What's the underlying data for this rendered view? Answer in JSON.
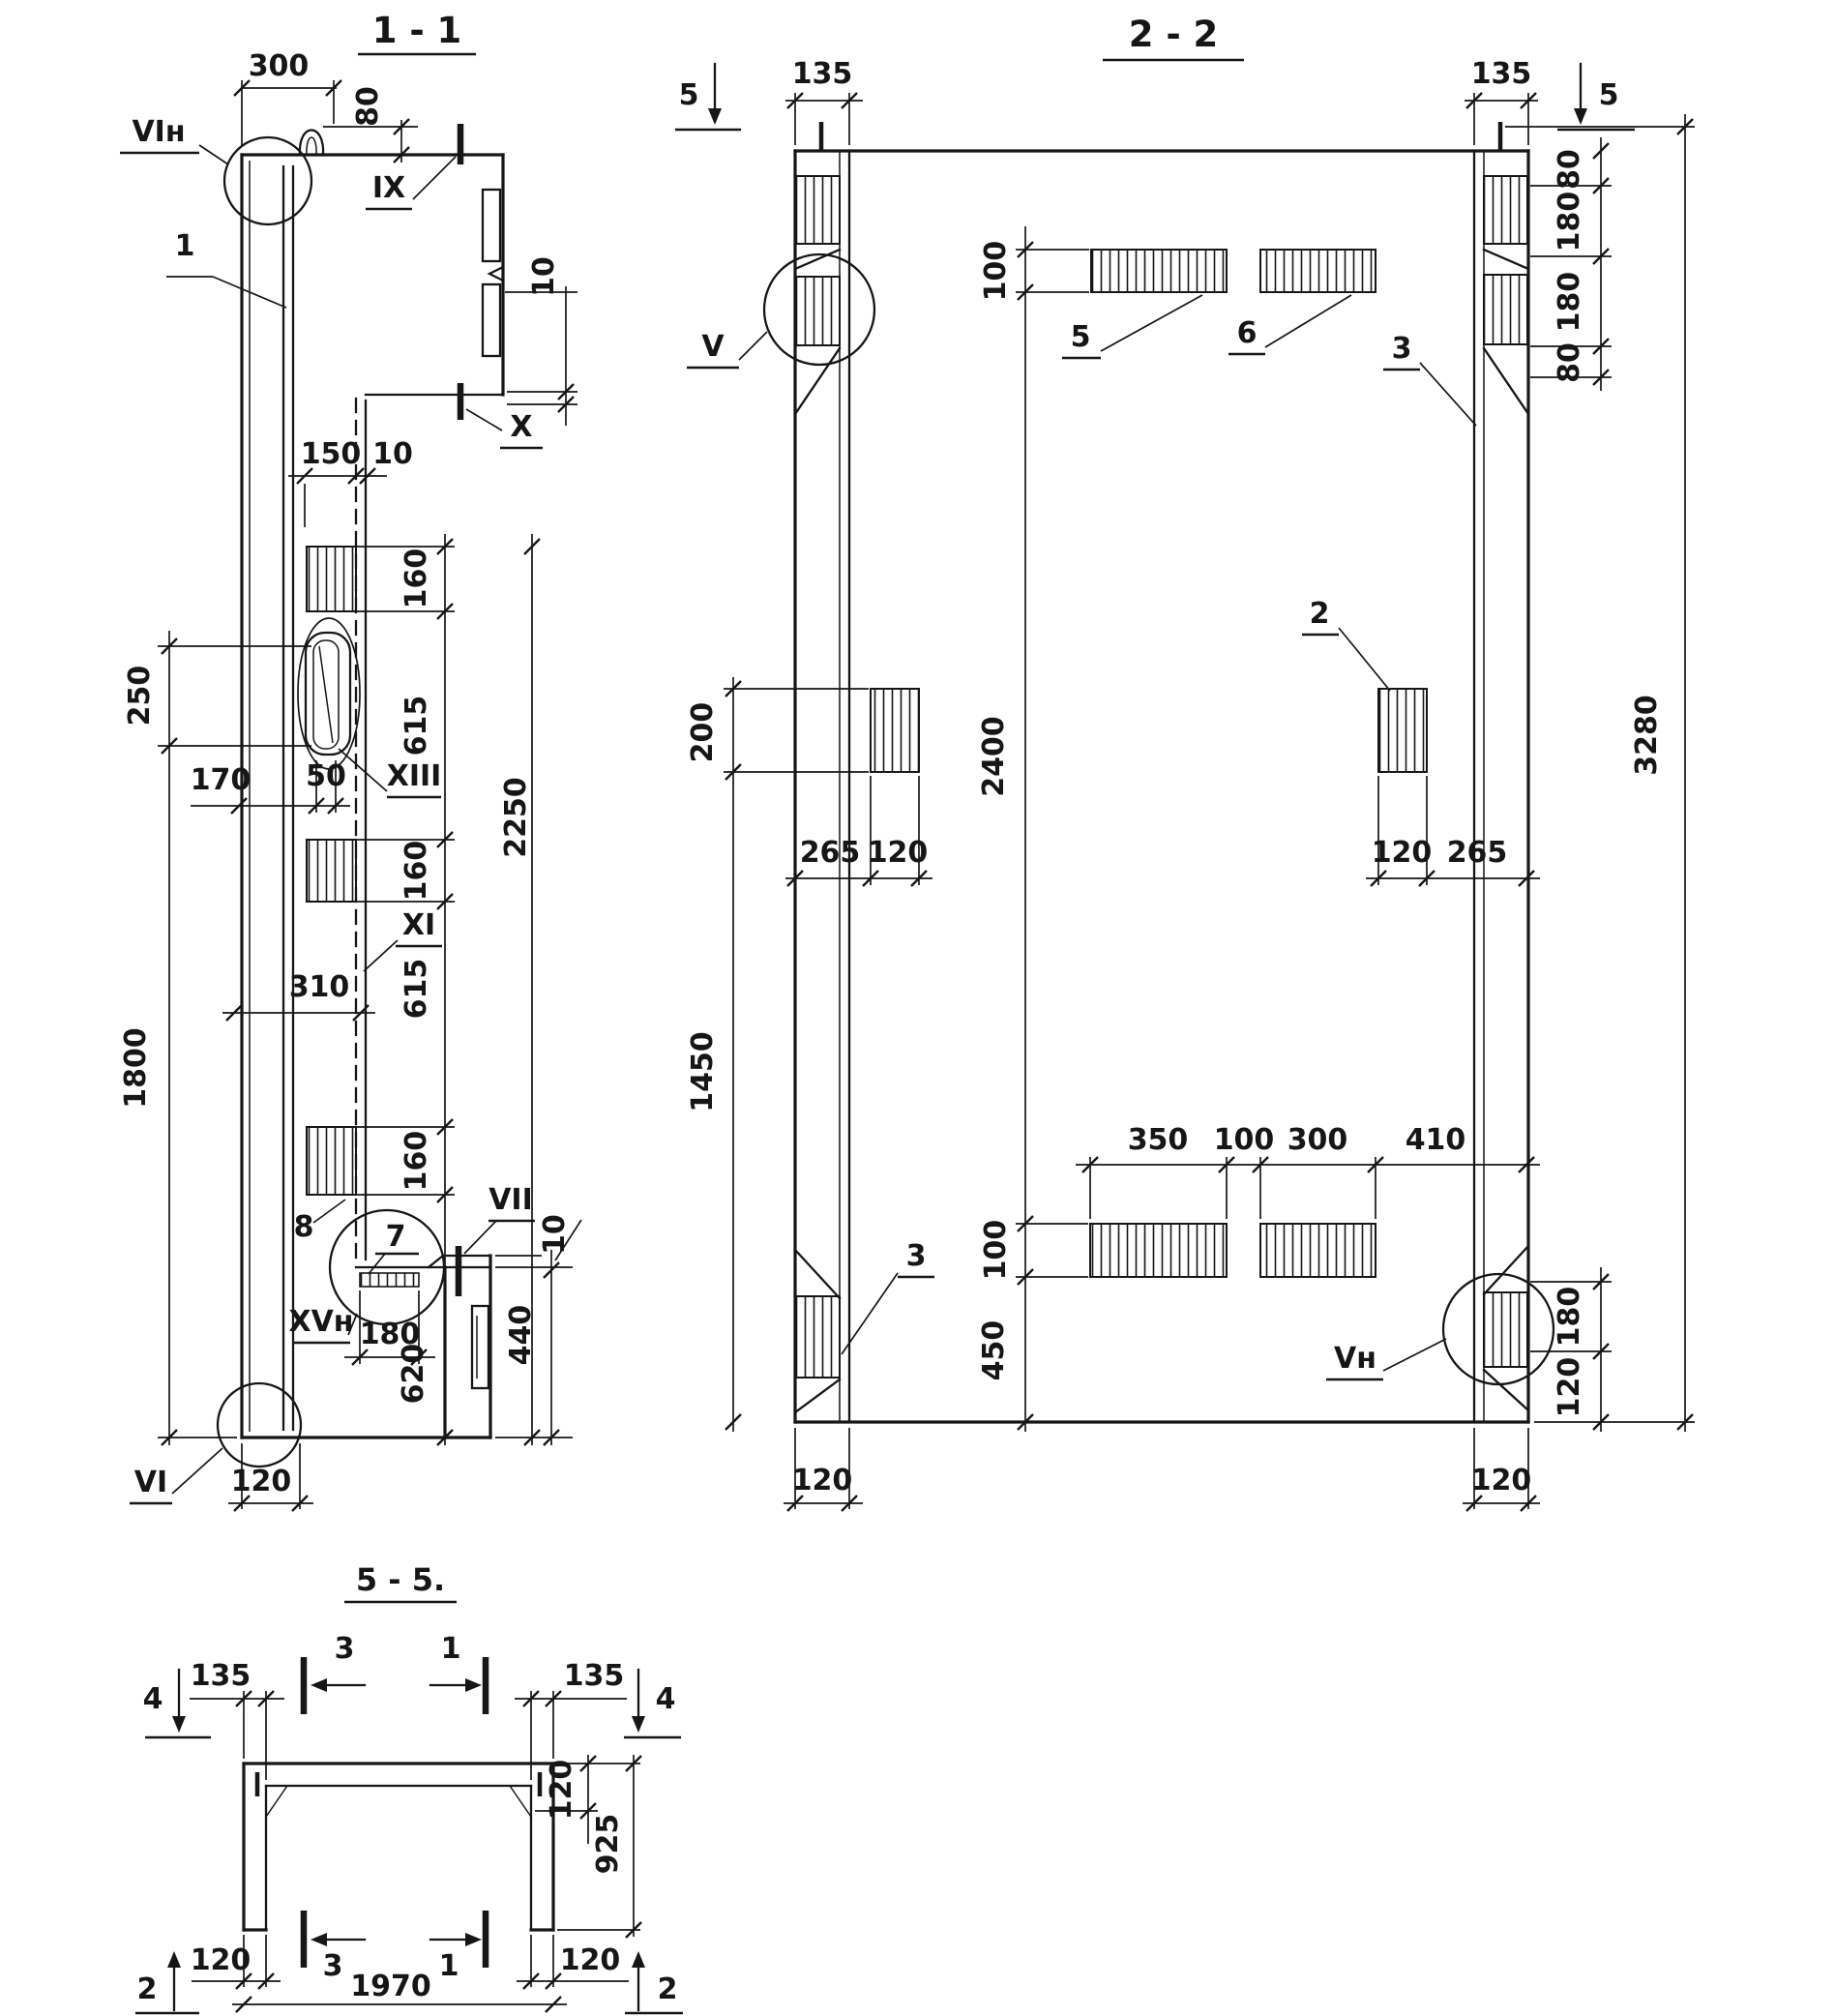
{
  "colors": {
    "ink": "#161616",
    "paper": "#ffffff"
  },
  "s11": {
    "title": "1 - 1",
    "labels": {
      "vi_top": "VIн",
      "bar1": "1",
      "ix": "IX",
      "x": "X",
      "xiii": "XIII",
      "xi": "XI",
      "vii": "VII",
      "xv": "XVн",
      "vi_bottom": "VI",
      "item8": "8",
      "item7": "7"
    },
    "dims": {
      "w300": "300",
      "h80": "80",
      "notch10": "10",
      "w150": "150",
      "web10": "10",
      "s160a": "160",
      "slot250": "250",
      "s615a": "615",
      "w170": "170",
      "slot50": "50",
      "v2250": "2250",
      "s160b": "160",
      "w310": "310",
      "s615b": "615",
      "v1800": "1800",
      "s160c": "160",
      "step10": "10",
      "v440": "440",
      "w180": "180",
      "v620": "620",
      "w120": "120"
    }
  },
  "s22": {
    "title": "2 - 2",
    "marks": {
      "cut5_left": "5",
      "cut5_right": "5"
    },
    "labels": {
      "v": "V",
      "item5": "5",
      "item6": "6",
      "item3_right": "3",
      "item2": "2",
      "item3_left": "3",
      "vn": "Vн"
    },
    "dims": {
      "t135l": "135",
      "t135r": "135",
      "r80a": "80",
      "r180a": "180",
      "r180b": "180",
      "r80b": "80",
      "top100": "100",
      "l200": "200",
      "v2400": "2400",
      "l265": "265",
      "l120": "120",
      "r120": "120",
      "r265": "265",
      "v3280": "3280",
      "v1450": "1450",
      "b350": "350",
      "b100": "100",
      "b300": "300",
      "b410": "410",
      "b100v": "100",
      "b450": "450",
      "rb180": "180",
      "rb120": "120",
      "bl120": "120",
      "br120": "120"
    }
  },
  "s55": {
    "title": "5 - 5.",
    "marks": {
      "cut3_top": "3",
      "cut1_top": "1",
      "cut4_left": "4",
      "cut4_right": "4",
      "cut3_bot": "3",
      "cut1_bot": "1",
      "cut2_left": "2",
      "cut2_right": "2"
    },
    "dims": {
      "t135l": "135",
      "t135r": "135",
      "r120": "120",
      "r925": "925",
      "b120l": "120",
      "b120r": "120",
      "w1970": "1970"
    }
  }
}
